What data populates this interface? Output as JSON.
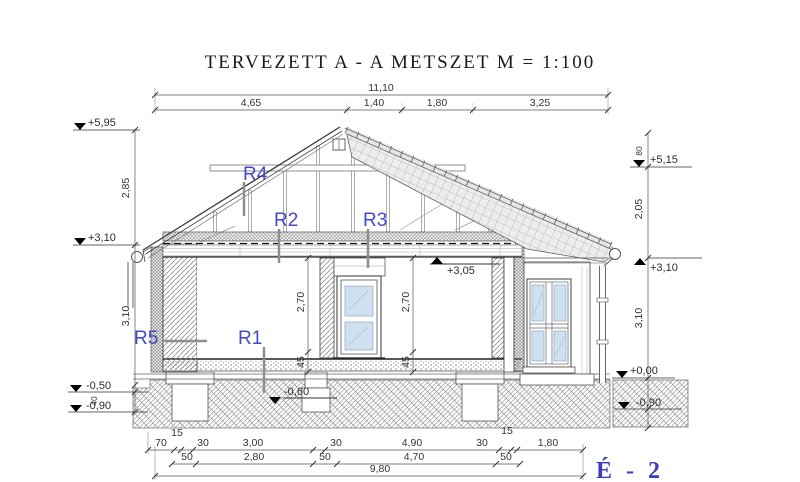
{
  "title": "TERVEZETT A - A METSZET  M = 1:100",
  "sheet_label": "É - 2",
  "colors": {
    "label_blue": "#4449c8",
    "sheet_blue": "#3d3dbb",
    "line_dark": "#3d3d3d",
    "glass_blue": "#cfe0f0",
    "tile_gray": "#ededed"
  },
  "top_dims": {
    "total": "11,10",
    "segments": [
      "4,65",
      "1,40",
      "1,80",
      "3,25"
    ]
  },
  "left_levels": [
    "+5,95",
    "+3,10",
    "-0,50",
    "-0,90"
  ],
  "left_heights": [
    "2,85",
    "3,10",
    "40"
  ],
  "right_heights": [
    "80",
    "2,05",
    "3,10"
  ],
  "right_levels": [
    "+5,15",
    "+3,10",
    "+0,00",
    "-0,90"
  ],
  "interior": {
    "attic_floor_level": "+3,05",
    "foundation_level": "-0,60",
    "room_dims": [
      "2,70",
      "45",
      "2,70",
      "45"
    ]
  },
  "rebar": {
    "r1": "R1",
    "r2": "R2",
    "r3": "R3",
    "r4": "R4",
    "r5": "R5"
  },
  "bottom_dims": {
    "row1": [
      "70",
      "15",
      "30",
      "3,00",
      "30",
      "4,90",
      "30",
      "15",
      "1,80"
    ],
    "row2": [
      "50",
      "2,80",
      "50",
      "4,70",
      "50"
    ],
    "total": "9,80"
  }
}
